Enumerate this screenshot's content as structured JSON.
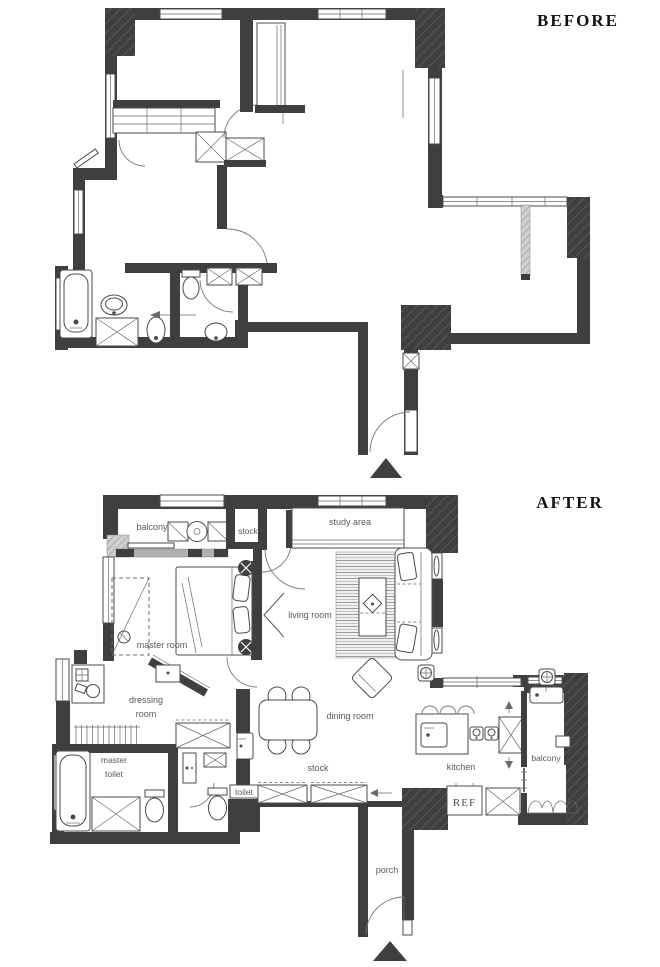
{
  "colors": {
    "wall": "#3f3f3f",
    "line": "#4b4b4b",
    "label": "#595959",
    "title": "#111111"
  },
  "before": {
    "title": "BEFORE"
  },
  "after": {
    "title": "AFTER",
    "labels": {
      "balcony_top": "balcony",
      "stock_top": "stock",
      "study_area": "study area",
      "living_room": "living room",
      "master_room": "master room",
      "dressing_room_line1": "dressing",
      "dressing_room_line2": "room",
      "master_toilet_line1": "master",
      "master_toilet_line2": "toilet",
      "toilet": "toilet",
      "dining_room": "dining room",
      "stock_bottom": "stock",
      "kitchen": "kitchen",
      "balcony_right": "balcony",
      "refrigerator": "REF",
      "porch": "porch"
    }
  }
}
